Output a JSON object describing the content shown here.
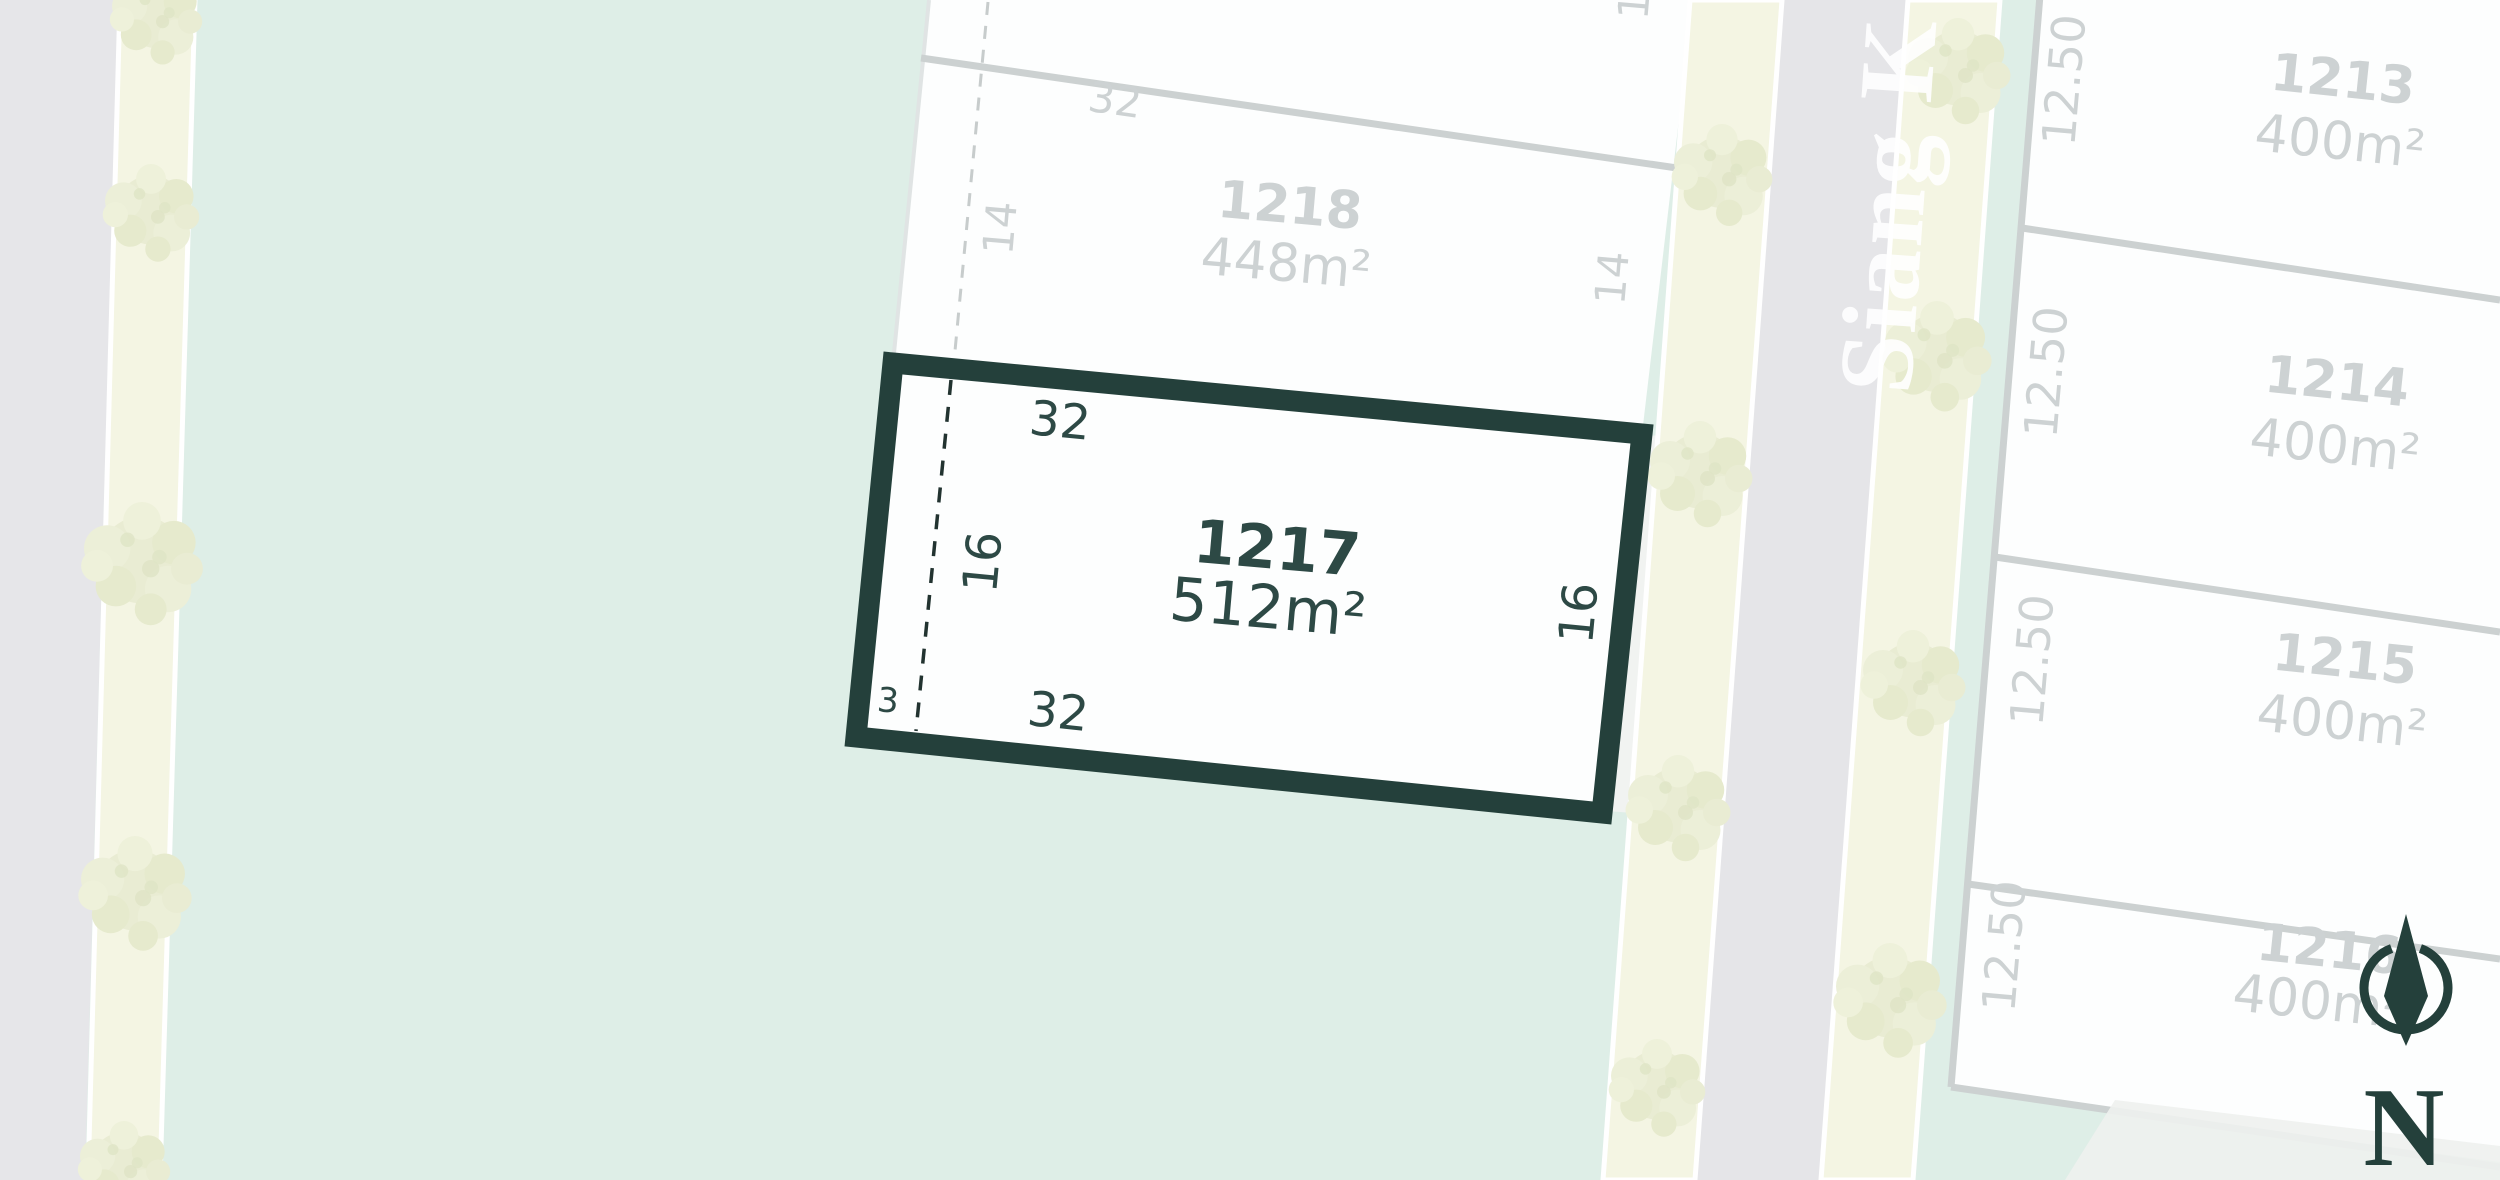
{
  "map": {
    "type": "estate-lot-plan",
    "street": {
      "name": "Siang K"
    },
    "compass": {
      "label": "N"
    },
    "highlight_lot": {
      "id": "1217",
      "area": "512m²",
      "dim_top": "32",
      "dim_bottom": "32",
      "dim_left": "16",
      "dim_right": "16",
      "dim_corner": "3"
    },
    "adjacent_lot": {
      "id": "1218",
      "area": "448m²",
      "dim_top": "32",
      "dim_left": "14",
      "dim_right": "14",
      "dim_partial_top": "1"
    },
    "right_lots": [
      {
        "id": "1213",
        "area": "400m²",
        "frontage": "12.50"
      },
      {
        "id": "1214",
        "area": "400m²",
        "frontage": "12.50"
      },
      {
        "id": "1215",
        "area": "400m²",
        "frontage": "12.50"
      },
      {
        "id": "1216",
        "area": "400m²",
        "frontage": "12.50"
      }
    ],
    "colors": {
      "open_space_mint": "#deeee7",
      "road_gray": "#e6e6e9",
      "verge_cream": "#f4f5e3",
      "tree_green": "#e9ecd3",
      "lot_white": "#fdfefe",
      "boundary_gray": "#ccd1d1",
      "faded_text": "#cdd2d3",
      "accent_dark_teal": "#24403b"
    }
  }
}
